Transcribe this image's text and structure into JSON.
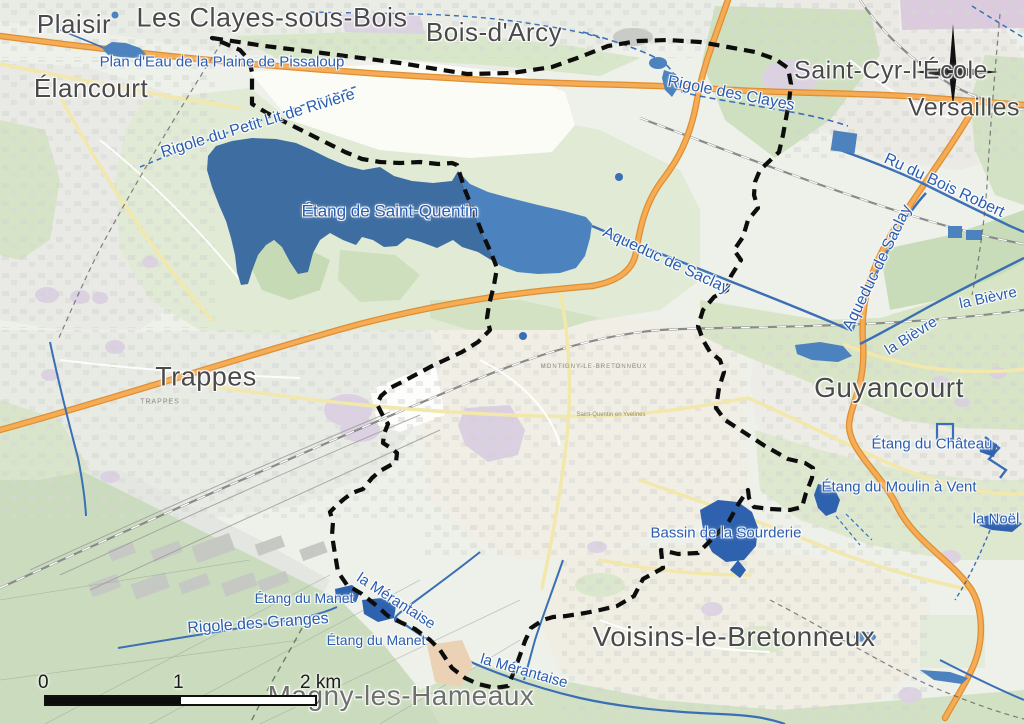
{
  "labels": {
    "cities": [
      {
        "text": "Plaisir"
      },
      {
        "text": "Les Clayes-sous-Bois"
      },
      {
        "text": "Bois-d'Arcy"
      },
      {
        "text": "Saint-Cyr-l'École"
      },
      {
        "text": "Versailles"
      },
      {
        "text": "Élancourt"
      },
      {
        "text": "Trappes"
      },
      {
        "text": "Guyancourt"
      },
      {
        "text": "Voisins-le-Bretonneux"
      },
      {
        "text": "Magny-les-Hameaux"
      }
    ],
    "water": [
      {
        "text": "Plan d'Eau de la Plaine de Pissaloup"
      },
      {
        "text": "Rigole du Petit Lit de Rivière"
      },
      {
        "text": "Étang de Saint-Quentin"
      },
      {
        "text": "Rigole des Clayes"
      },
      {
        "text": "Ru du Bois Robert"
      },
      {
        "text": "Aqueduc de Saclay"
      },
      {
        "text": "Aqueduc de Saclay"
      },
      {
        "text": "la Bièvre"
      },
      {
        "text": "la Bièvre"
      },
      {
        "text": "Étang du Château"
      },
      {
        "text": "Étang du Moulin à Vent"
      },
      {
        "text": "la Noël"
      },
      {
        "text": "Bassin de la Sourderie"
      },
      {
        "text": "Étang du Manet"
      },
      {
        "text": "Étang du Manet"
      },
      {
        "text": "Rigole des Granges"
      },
      {
        "text": "la Mérantaise"
      },
      {
        "text": "la Mérantaise"
      }
    ],
    "minor": [
      {
        "text": "TRAPPES"
      },
      {
        "text": "MONTIGNY-LE-BRETONNEUX"
      },
      {
        "text": "Saint-Quentin en Yvelines"
      }
    ]
  },
  "scale_bar": {
    "tick_0": "0",
    "tick_1": "1",
    "tick_2": "2 km"
  },
  "icons": {
    "compass": "compass-rose"
  },
  "colors": {
    "water_dark": "#3e6da2",
    "water_light": "#4c82bd",
    "water_line": "#3a6fb5",
    "water_label": "#2a5db0",
    "city_label": "#4a4a4a",
    "boundary": "#0d0d0d",
    "motorway": "#f0a44c",
    "secondary_road": "#f3e8ab",
    "green_area": "#d8e6c9",
    "urban_area": "#e9ebe5",
    "institutional_area": "#dbcfe3"
  }
}
